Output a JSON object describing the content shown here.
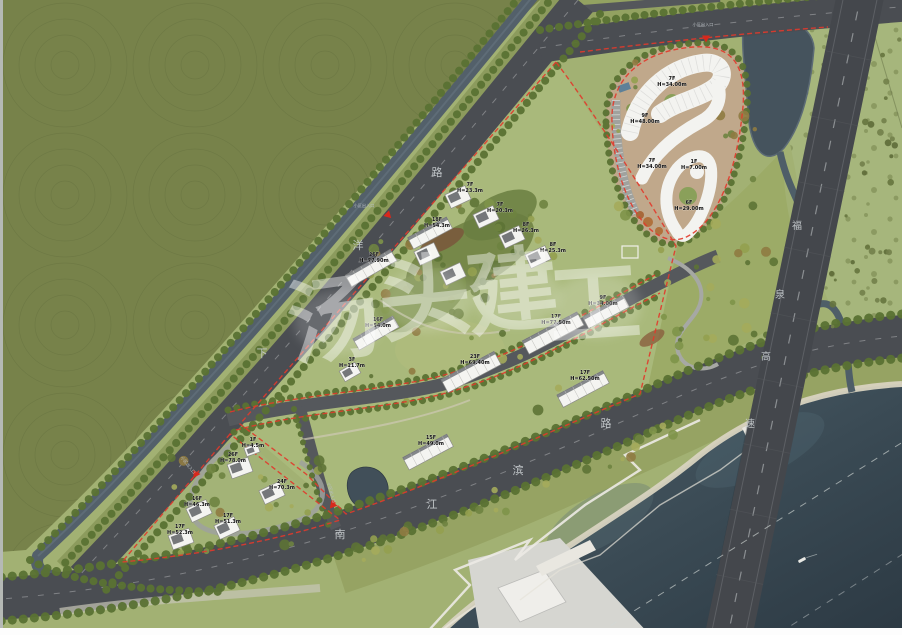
{
  "plan": {
    "type": "landscape-architecture-master-plan",
    "watermark": {
      "text": "汤头建工",
      "chars": [
        "汤",
        "头",
        "建",
        "工"
      ]
    },
    "roads": {
      "xiayang_road": {
        "name": "下洋路",
        "chars": [
          "下",
          "洋",
          "路"
        ]
      },
      "nanjiangbin_road": {
        "name": "南江滨路",
        "chars": [
          "南",
          "江",
          "滨",
          "路"
        ]
      },
      "expressway": {
        "name": "福泉高速",
        "chars": [
          "福",
          "泉",
          "高",
          "速"
        ]
      }
    },
    "entrances": [
      {
        "label": "小区出入口"
      },
      {
        "label": "小区出入口"
      },
      {
        "label": "小区出入口"
      },
      {
        "label": "小区出入口"
      }
    ],
    "buildings": [
      {
        "area": "northeast-commercial",
        "floors": "7F",
        "height": "H=34.00m"
      },
      {
        "area": "northeast-commercial",
        "floors": "9F",
        "height": "H=48.00m"
      },
      {
        "area": "northeast-commercial",
        "floors": "7F",
        "height": "H=34.00m"
      },
      {
        "area": "northeast-commercial",
        "floors": "1F",
        "height": "H=7.00m"
      },
      {
        "area": "northeast-commercial",
        "floors": "6F",
        "height": "H=29.00m"
      },
      {
        "area": "central-upper",
        "floors": "7F",
        "height": "H=23.3m"
      },
      {
        "area": "central-upper",
        "floors": "7F",
        "height": "H=20.3m"
      },
      {
        "area": "central-upper",
        "floors": "8F",
        "height": "H=26.3m"
      },
      {
        "area": "central-upper",
        "floors": "8F",
        "height": "H=25.3m"
      },
      {
        "area": "central-upper",
        "floors": "18F",
        "height": "H=54.3m"
      },
      {
        "area": "central-west",
        "floors": "26F",
        "height": "H=77.90m"
      },
      {
        "area": "central-west",
        "floors": "16F",
        "height": "H=54.0m"
      },
      {
        "area": "central-west",
        "floors": "3F",
        "height": "H=11.7m"
      },
      {
        "area": "central-lower",
        "floors": "17F",
        "height": "H=77.50m"
      },
      {
        "area": "central-lower",
        "floors": "9F",
        "height": "H=34.00m"
      },
      {
        "area": "central-lower",
        "floors": "23F",
        "height": "H=69.40m"
      },
      {
        "area": "central-lower",
        "floors": "17F",
        "height": "H=62.50m"
      },
      {
        "area": "central-lower",
        "floors": "15F",
        "height": "H=49.0m"
      },
      {
        "area": "southwest",
        "floors": "1F",
        "height": "H=4.5m"
      },
      {
        "area": "southwest",
        "floors": "26F",
        "height": "H=78.0m"
      },
      {
        "area": "southwest",
        "floors": "24F",
        "height": "H=70.3m"
      },
      {
        "area": "southwest",
        "floors": "16F",
        "height": "H=46.3m"
      },
      {
        "area": "southwest",
        "floors": "17F",
        "height": "H=51.3m"
      },
      {
        "area": "southwest",
        "floors": "17F",
        "height": "H=52.3m"
      }
    ],
    "colors": {
      "field": "#77824a",
      "lawn": "#a9b97b",
      "river": "#35444e",
      "canal": "#53606a",
      "road": "#4a4d52",
      "expressway": "#44474c",
      "boundary": "#e23a2c",
      "building": "#f4f4f1",
      "sand": "#d8d3c0"
    }
  }
}
